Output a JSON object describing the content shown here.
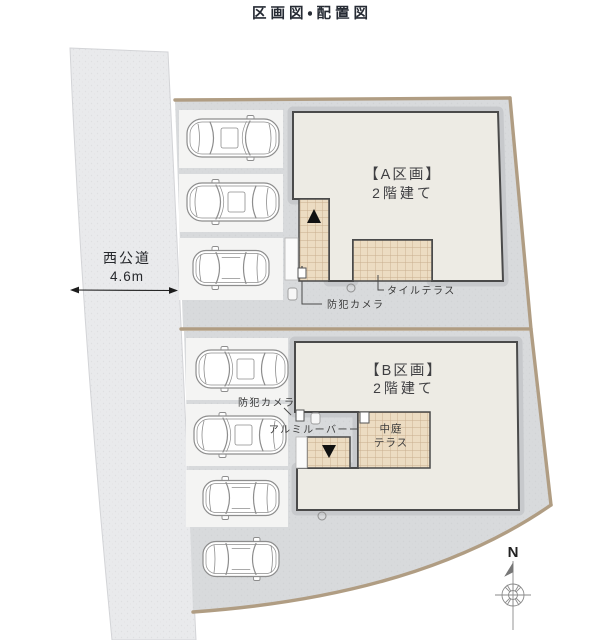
{
  "title": "区画図・配置図",
  "road": {
    "name": "西公道",
    "width": "4.6m"
  },
  "plot_a": {
    "name": "【A区画】",
    "floors": "2階建て",
    "tile_terrace": "タイルテラス",
    "security_camera": "防犯カメラ",
    "cars_parked": 3
  },
  "plot_b": {
    "name": "【B区画】",
    "floors": "2階建て",
    "security_camera": "防犯カメラ",
    "aluminum_louver": "アルミルーバー",
    "courtyard_terrace_line1": "中庭",
    "courtyard_terrace_line2": "テラス",
    "cars_parked": 4
  },
  "compass": {
    "north": "N"
  },
  "colors": {
    "plot_fill": "#d8dadc",
    "road_fill": "#e9eaec",
    "building_fill": "#edebe4",
    "building_outline": "#4a4a4a",
    "tile_fill": "#ecdcc2",
    "tile_grid": "#c9ae8d",
    "boundary_line": "#b09d83",
    "stall_fill": "#f4f4f3",
    "entrance_marker": "#111111"
  }
}
